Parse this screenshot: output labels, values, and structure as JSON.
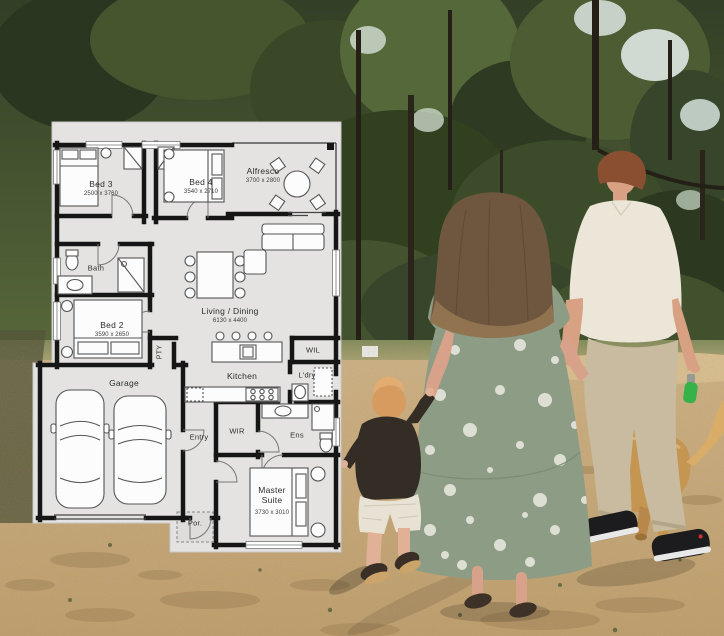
{
  "floorplan": {
    "rooms": [
      {
        "id": "bed3",
        "label": "Bed 3",
        "dims": "2500 x 3760"
      },
      {
        "id": "bed4",
        "label": "Bed 4",
        "dims": "3540 x 2710"
      },
      {
        "id": "alfresco",
        "label": "Alfresco",
        "dims": "3700 x 2800"
      },
      {
        "id": "living",
        "label": "Living / Dining",
        "dims": "6130 x 4400"
      },
      {
        "id": "bath",
        "label": "Bath"
      },
      {
        "id": "bed2",
        "label": "Bed 2",
        "dims": "3590 x 2650"
      },
      {
        "id": "pantry",
        "label": "PTY"
      },
      {
        "id": "kitchen",
        "label": "Kitchen"
      },
      {
        "id": "wil",
        "label": "WIL"
      },
      {
        "id": "laundry",
        "label": "L'dry"
      },
      {
        "id": "garage",
        "label": "Garage"
      },
      {
        "id": "entry",
        "label": "Entry"
      },
      {
        "id": "wir",
        "label": "WIR"
      },
      {
        "id": "ensuite",
        "label": "Ens"
      },
      {
        "id": "master",
        "label": "Master Suite",
        "dims": "3730 x 3010"
      },
      {
        "id": "porch",
        "label": "Por."
      }
    ],
    "colors": {
      "sheet": "#e4e3e1",
      "wall": "#161616",
      "fixture": "#555555"
    }
  },
  "photo": {
    "colors": {
      "tree_green": "#46552e",
      "ground_tan": "#c9a873",
      "dress_sage": "#8d9c84",
      "shirt_cream": "#ebe6d8",
      "pants_khaki": "#c8bb9f",
      "dog_gold": "#c59552",
      "hair_brown": "#6e563f",
      "bag_green": "#35b24a"
    }
  }
}
